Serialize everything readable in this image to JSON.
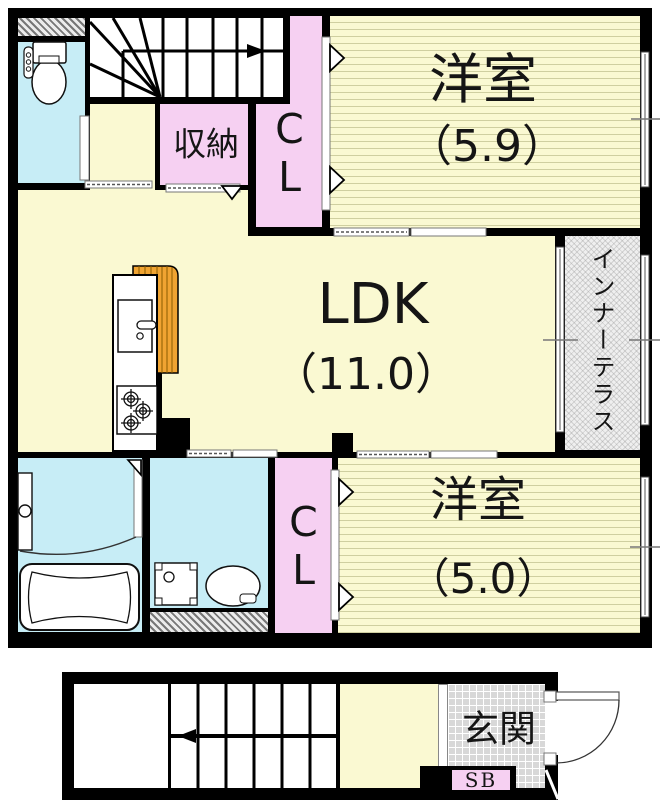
{
  "plan": {
    "rooms": {
      "ldk": {
        "name": "LDK",
        "area": "（11.0）"
      },
      "western_top": {
        "name": "洋室",
        "area": "（5.9）"
      },
      "western_bottom": {
        "name": "洋室",
        "area": "（5.0）"
      },
      "storage": {
        "name": "収納"
      },
      "closet_top": {
        "name": "CL"
      },
      "closet_bottom": {
        "name": "CL"
      },
      "inner_terrace": {
        "name": "インナーテラス"
      },
      "entrance": {
        "name": "玄関"
      },
      "shoe_box": {
        "name": "SB"
      }
    },
    "colors": {
      "wall": "#000000",
      "room_yellow": "#FAF9D2",
      "closet_pink": "#F6D0F2",
      "wet_area_cyan": "#C7EDF6",
      "kitchen_counter_orange": "#F0A432",
      "terrace_gray": "#EFEFEF",
      "entrance_tile_gray": "#D8D8D8"
    }
  }
}
